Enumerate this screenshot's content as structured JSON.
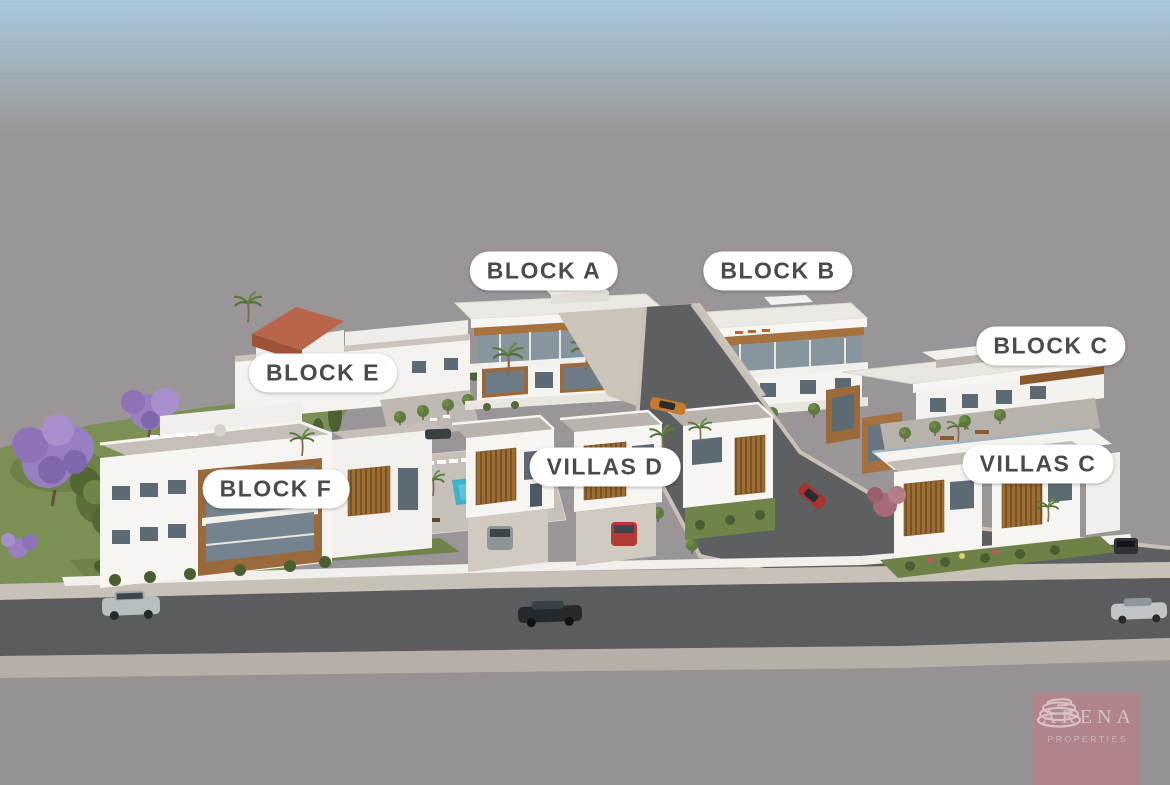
{
  "scene": {
    "description": "Aerial 3D architectural rendering of a white residential development on a gray untextured base: apartment blocks and rows of two-storey villas with wooden louvers and roof terraces, a small turquoise pool, asphalt roads with cars, lawns, jacaranda and palm trees.",
    "type": "architectural-render"
  },
  "labels": [
    {
      "id": "block-a",
      "text": "BLOCK A"
    },
    {
      "id": "block-b",
      "text": "BLOCK B"
    },
    {
      "id": "block-c",
      "text": "BLOCK C"
    },
    {
      "id": "block-e",
      "text": "BLOCK E"
    },
    {
      "id": "block-f",
      "text": "BLOCK F"
    },
    {
      "id": "villas-d",
      "text": "VILLAS D"
    },
    {
      "id": "villas-c",
      "text": "VILLAS C"
    }
  ],
  "logo": {
    "name": "ARENA",
    "subtitle": "PROPERTIES"
  },
  "palette": {
    "sky_top": "#a9c8dd",
    "ground_gray": "#9a9596",
    "road_asphalt": "#5e5f61",
    "sidewalk": "#c8c1b7",
    "building_white": "#f6f4f1",
    "wood_accent": "#9a6a3d",
    "terracotta_roof": "#b25f45",
    "pool_water": "#3db2c8",
    "lawn_green": "#7b9054",
    "jacaranda_purple": "#9a7ec2",
    "label_background": "#ffffff",
    "label_text": "#4b4b4d",
    "logo_background": "#b2838b",
    "logo_text": "#d6c0c3"
  }
}
